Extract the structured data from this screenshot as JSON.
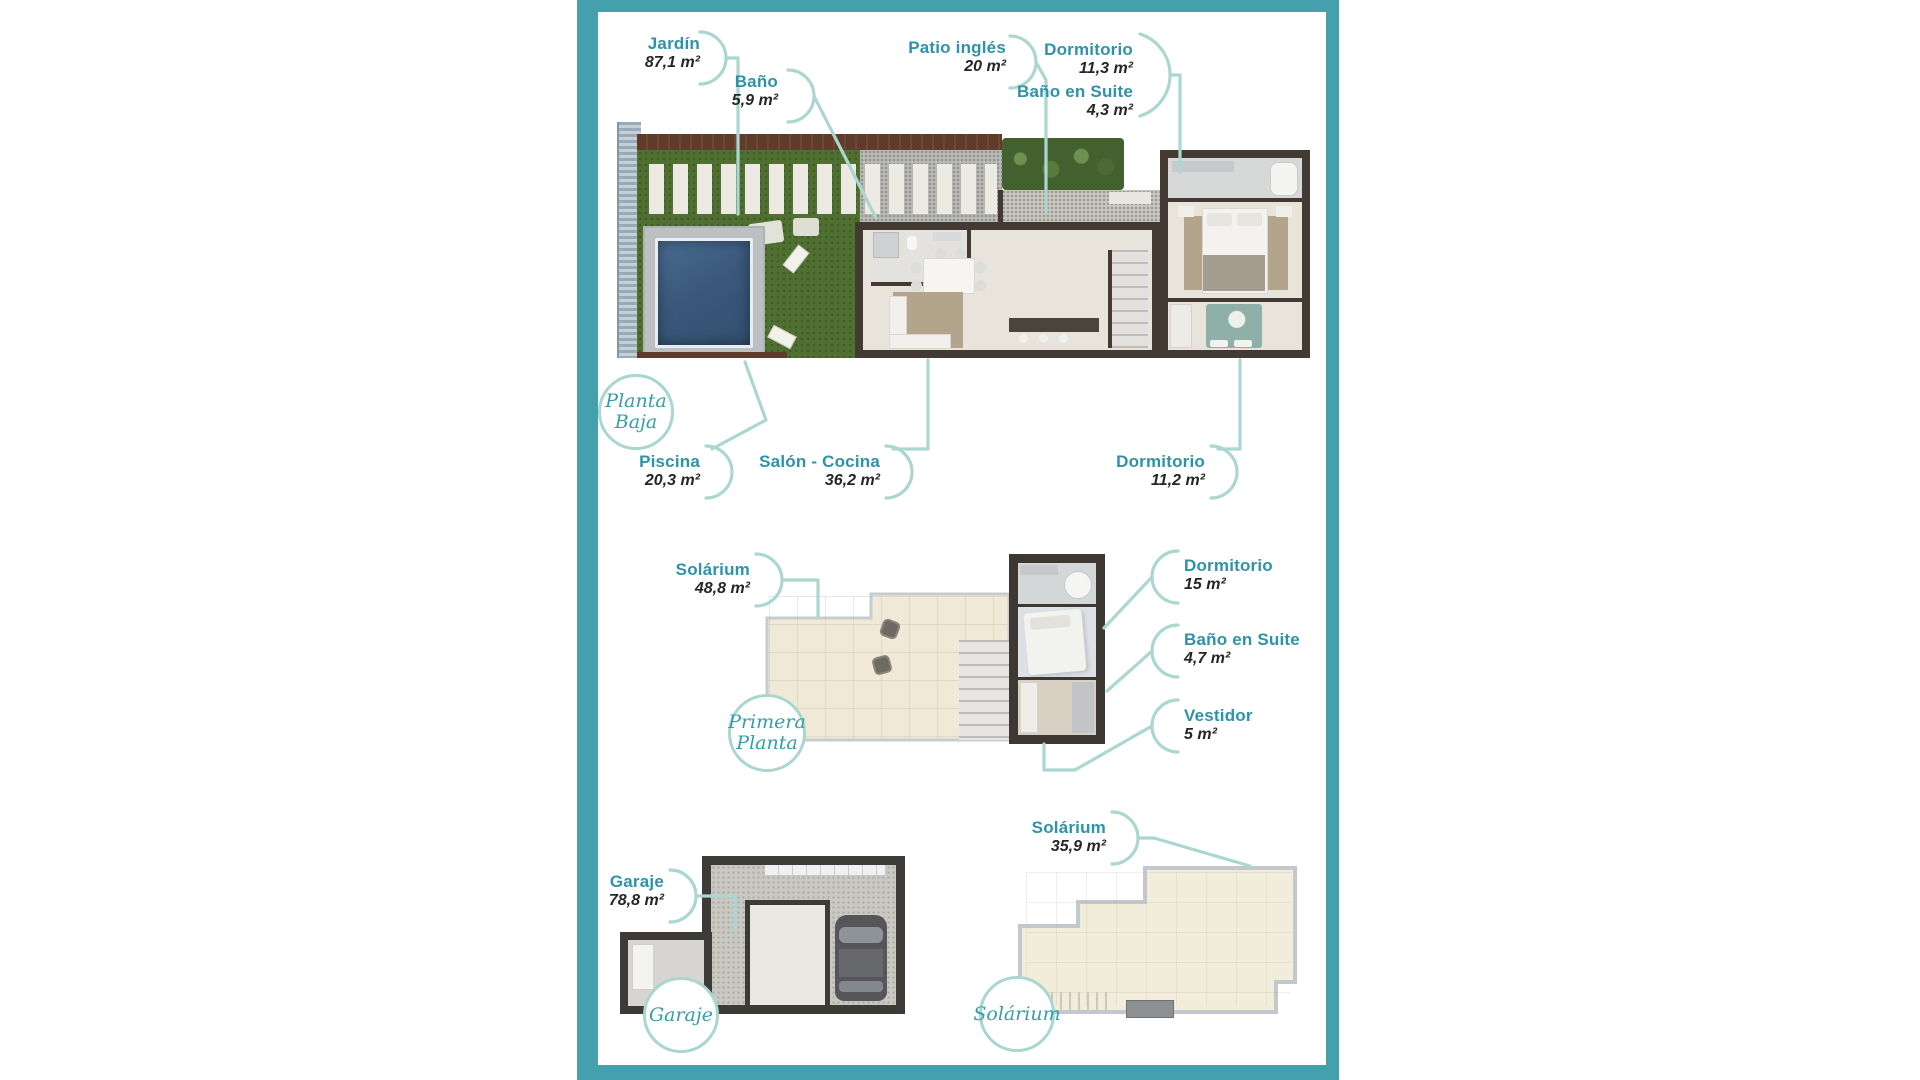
{
  "colors": {
    "frame": "#45a0ae",
    "accent": "#2e93a8",
    "leader": "#abd7d0",
    "area_text": "#262626",
    "circle_border": "#a9d6cf",
    "circle_text": "#339fab"
  },
  "floors": [
    {
      "name": "planta-baja",
      "title": "Planta Baja",
      "rooms": [
        {
          "label": "Jardín",
          "area": "87,1 m²"
        },
        {
          "label": "Baño",
          "area": "5,9 m²"
        },
        {
          "label": "Patio inglés",
          "area": "20 m²"
        },
        {
          "label": "Dormitorio",
          "area": "11,3 m²"
        },
        {
          "label": "Baño en Suite",
          "area": "4,3 m²"
        },
        {
          "label": "Piscina",
          "area": "20,3 m²"
        },
        {
          "label": "Salón - Cocina",
          "area": "36,2 m²"
        },
        {
          "label": "Dormitorio",
          "area": "11,2 m²"
        }
      ]
    },
    {
      "name": "primera-planta",
      "title": "Primera Planta",
      "rooms": [
        {
          "label": "Solárium",
          "area": "48,8 m²"
        },
        {
          "label": "Dormitorio",
          "area": "15 m²"
        },
        {
          "label": "Baño en Suite",
          "area": "4,7 m²"
        },
        {
          "label": "Vestidor",
          "area": "5 m²"
        }
      ]
    },
    {
      "name": "garaje",
      "title": "Garaje",
      "rooms": [
        {
          "label": "Garaje",
          "area": "78,8 m²"
        }
      ]
    },
    {
      "name": "solarium",
      "title": "Solárium",
      "rooms": [
        {
          "label": "Solárium",
          "area": "35,9 m²"
        }
      ]
    }
  ]
}
